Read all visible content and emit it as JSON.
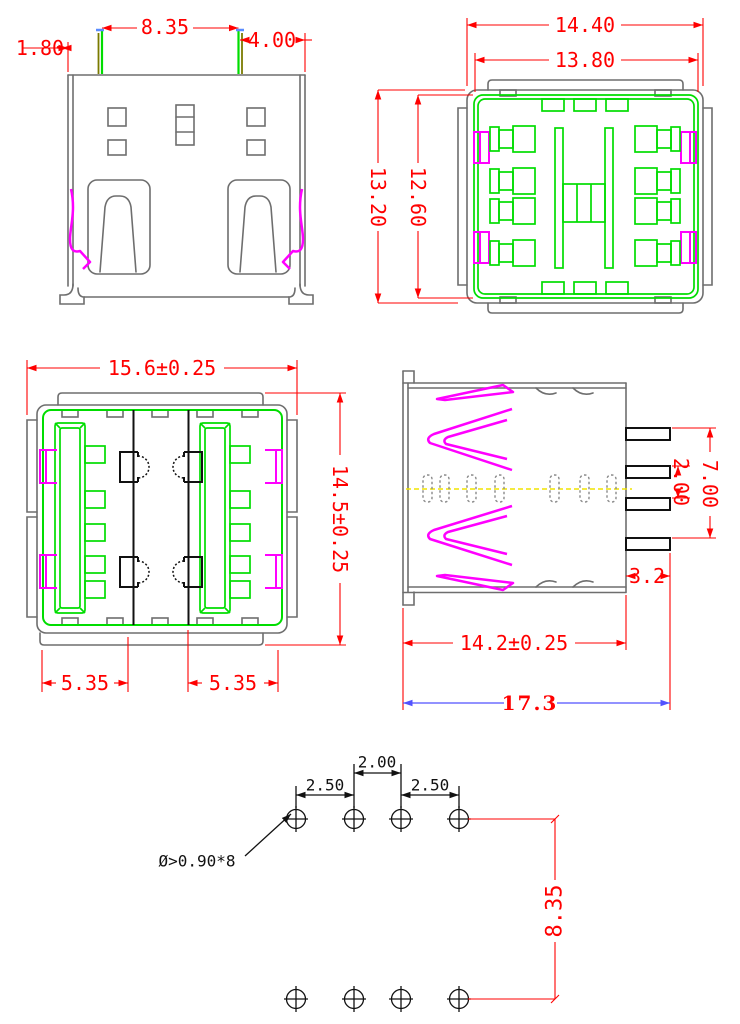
{
  "views": {
    "front_view": {
      "dim_pin_left_offset": "1.80",
      "dim_pin_span": "8.35",
      "dim_pin_right_offset": "4.00"
    },
    "top_view": {
      "dim_width_outer": "14.40",
      "dim_width_inner": "13.80",
      "dim_height_outer": "13.20",
      "dim_height_inner": "12.60"
    },
    "face_view": {
      "dim_width": "15.6±0.25",
      "dim_height": "14.5±0.25",
      "dim_port_left": "5.35",
      "dim_port_right": "5.35"
    },
    "side_view": {
      "dim_pin_row_span": "7.00",
      "dim_pin_pitch": "2.00",
      "dim_pin_stub": "3.2",
      "dim_body_depth": "14.2±0.25",
      "dim_overall_depth": "17.3"
    },
    "hole_layout": {
      "dim_pitch_left": "2.50",
      "dim_pitch_center": "2.00",
      "dim_pitch_right": "2.50",
      "hole_note": "Ø>0.90*8",
      "dim_row_spacing": "8.35"
    }
  },
  "colors": {
    "dimension_red": "#ff0000",
    "outline_gray": "#6e6e6e",
    "contact_green": "#00dd00",
    "spring_magenta": "#ff00ff",
    "wire_yellow": "#f0e400",
    "overall_dim_blue": "#5252ff",
    "pin_black": "#111111",
    "pin_olive": "#7a7a00",
    "tick_blue": "#5a8cff"
  }
}
